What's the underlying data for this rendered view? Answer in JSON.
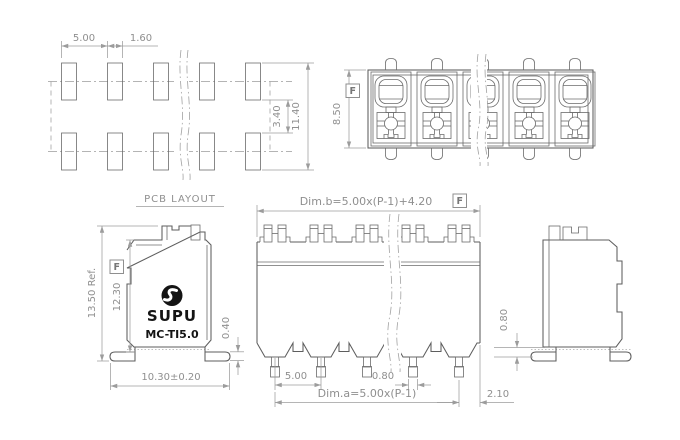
{
  "pcb": {
    "title": "PCB LAYOUT",
    "pitch": "5.00",
    "pad_width": "1.60",
    "row_gap": "3.40",
    "total_height": "11.40"
  },
  "top_view": {
    "height": "8.50",
    "datum": "F"
  },
  "side_view_left": {
    "overall_height": "13.50 Ref.",
    "body_height": "12.30",
    "datum": "F",
    "width": "10.30±0.20",
    "foot_thickness": "0.40",
    "brand": "SUPU",
    "model": "MC-TI5.0"
  },
  "front_view": {
    "dim_b": "Dim.b=5.00x(P-1)+4.20",
    "datum": "F",
    "pitch": "5.00",
    "pin_width": "0.80",
    "dim_a": "Dim.a=5.00x(P-1)",
    "edge_offset": "2.10"
  },
  "side_view_right": {
    "standoff": "0.80"
  },
  "colors": {
    "line": "#5e5e5e",
    "dimension": "#9c9c9c",
    "logo": "#141414",
    "background": "#ffffff"
  }
}
